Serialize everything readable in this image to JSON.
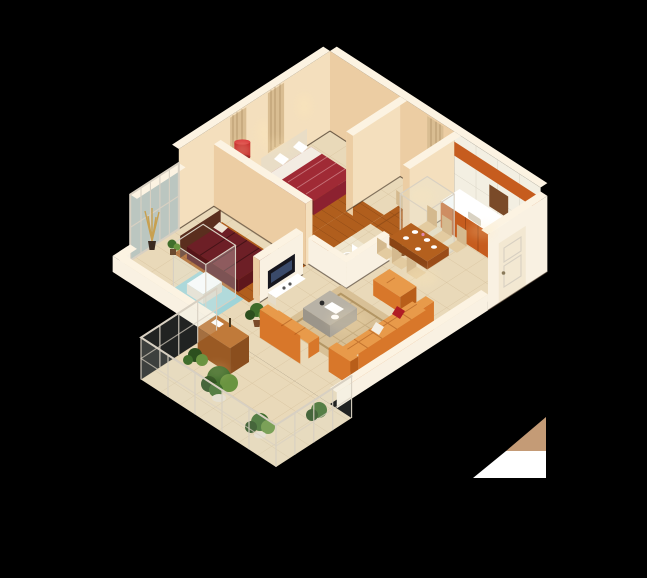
{
  "scene": {
    "type": "3d-isometric-apartment-floor-plan-render",
    "background": "black",
    "rooms": [
      {
        "id": "master-bedroom",
        "features": [
          "double-bed-red-duvet",
          "white-pillows",
          "headboard-shelf",
          "curtains",
          "wood-floor"
        ]
      },
      {
        "id": "second-bedroom",
        "features": [
          "double-bed-maroon-duvet",
          "headboard",
          "wood-floor"
        ]
      },
      {
        "id": "study",
        "features": [
          "white-desk",
          "desk-chair",
          "bookshelf",
          "curtain",
          "wood-floor"
        ]
      },
      {
        "id": "kitchen",
        "features": [
          "white-tile-wall",
          "orange-upper-cabinets",
          "orange-base-cabinets",
          "white-countertop",
          "glass-pantry-box"
        ]
      },
      {
        "id": "dining-area",
        "features": [
          "brown-dining-table",
          "white-plates",
          "six-beige-chairs"
        ]
      },
      {
        "id": "bathroom",
        "features": [
          "white-toilet",
          "low-white-partition-walls",
          "tile-floor"
        ]
      },
      {
        "id": "shower-room",
        "features": [
          "glass-shower-enclosure",
          "white-tub",
          "blue-mosaic-floor"
        ]
      },
      {
        "id": "living-room",
        "features": [
          "beige-area-rug",
          "orange-l-shaped-sofa",
          "orange-ottoman",
          "grey-coffee-table",
          "tv-partition-wall",
          "flat-tv",
          "floor-plant"
        ]
      },
      {
        "id": "hallway",
        "features": [
          "wood-floor"
        ]
      },
      {
        "id": "balcony",
        "features": [
          "glass-metal-railing",
          "potted-plants",
          "wooden-sideboard",
          "tile-floor"
        ]
      },
      {
        "id": "entry",
        "features": [
          "white-paneled-door",
          "tall-white-wall"
        ]
      }
    ],
    "lighting": [
      "warm-ceiling-spots",
      "red-floor-lamp",
      "wall-wash-glows"
    ],
    "artifact": "tan-and-white-triangle-glitch-bottom-right"
  },
  "colors": {
    "background": "#000000",
    "wallLit": "#f4dfbd",
    "wallShade": "#eccda3",
    "wallTop": "#fcf3e2",
    "wallWhite": "#f9f1e2",
    "floorTile": "#e9d9b9",
    "wood": "#b05e1d",
    "woodDark": "#8a4a16",
    "rug": "#d8c096",
    "sofa": "#d8772a",
    "sofaDark": "#b85e1a",
    "sofaLight": "#e89a4a",
    "bedRed": "#a02a35",
    "bedDark": "#6d1f26",
    "white": "#ffffff",
    "tileBlue": "#9fd4d8",
    "kitchenOrange": "#c65c1e",
    "plantGreen": "#3f6d2b",
    "plantDark": "#2c4f1e",
    "plantLight": "#6a9440",
    "glass": "#dce9e2",
    "curtain": "#d9bd92",
    "tan": "#c49b76",
    "doorCream": "#f3e8d2",
    "lampRed": "#c0161c",
    "tableBrown": "#b4601e",
    "chairBeige": "#e3cba0",
    "tableGrey": "#b8b2a6",
    "tableGreyDark": "#9b958a",
    "frameColor": "#d8d0c2",
    "glow": "#ffe9b8"
  }
}
